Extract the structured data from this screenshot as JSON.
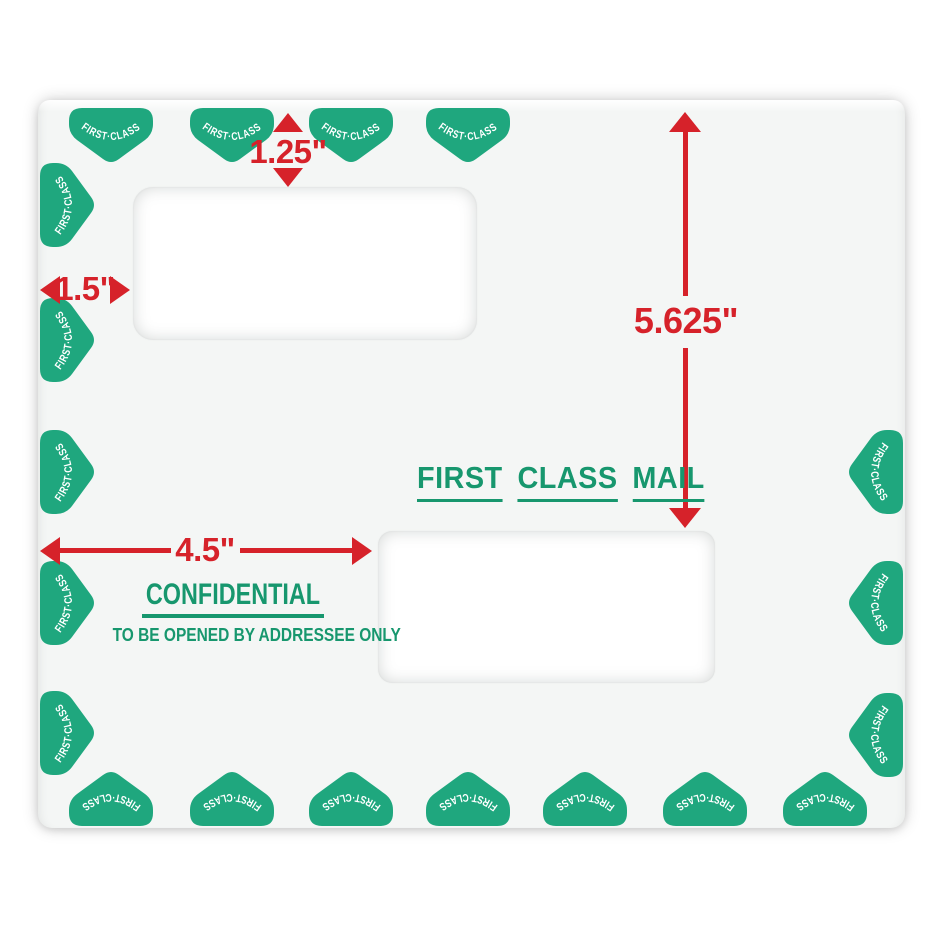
{
  "colors": {
    "stamp_green": "#1fa77e",
    "marking_green": "#17976e",
    "dimension_red": "#d6222a",
    "envelope_bg": "#f4f6f5",
    "window_bg": "#ffffff",
    "page_bg": "#ffffff"
  },
  "stamps": {
    "label": "FIRST·CLASS",
    "counts": {
      "top": 4,
      "left": 5,
      "bottom": 7,
      "right": 3
    }
  },
  "dimensions": {
    "window_top_offset": "1.25\"",
    "window_left_offset": "1.5\"",
    "right_height": "5.625\"",
    "window_bottom_left_offset": "4.5\""
  },
  "markings": {
    "first_class_mail": [
      "FIRST",
      "CLASS",
      "MAIL"
    ],
    "confidential": "CONFIDENTIAL",
    "addressee_notice": "TO BE OPENED BY ADDRESSEE ONLY"
  }
}
